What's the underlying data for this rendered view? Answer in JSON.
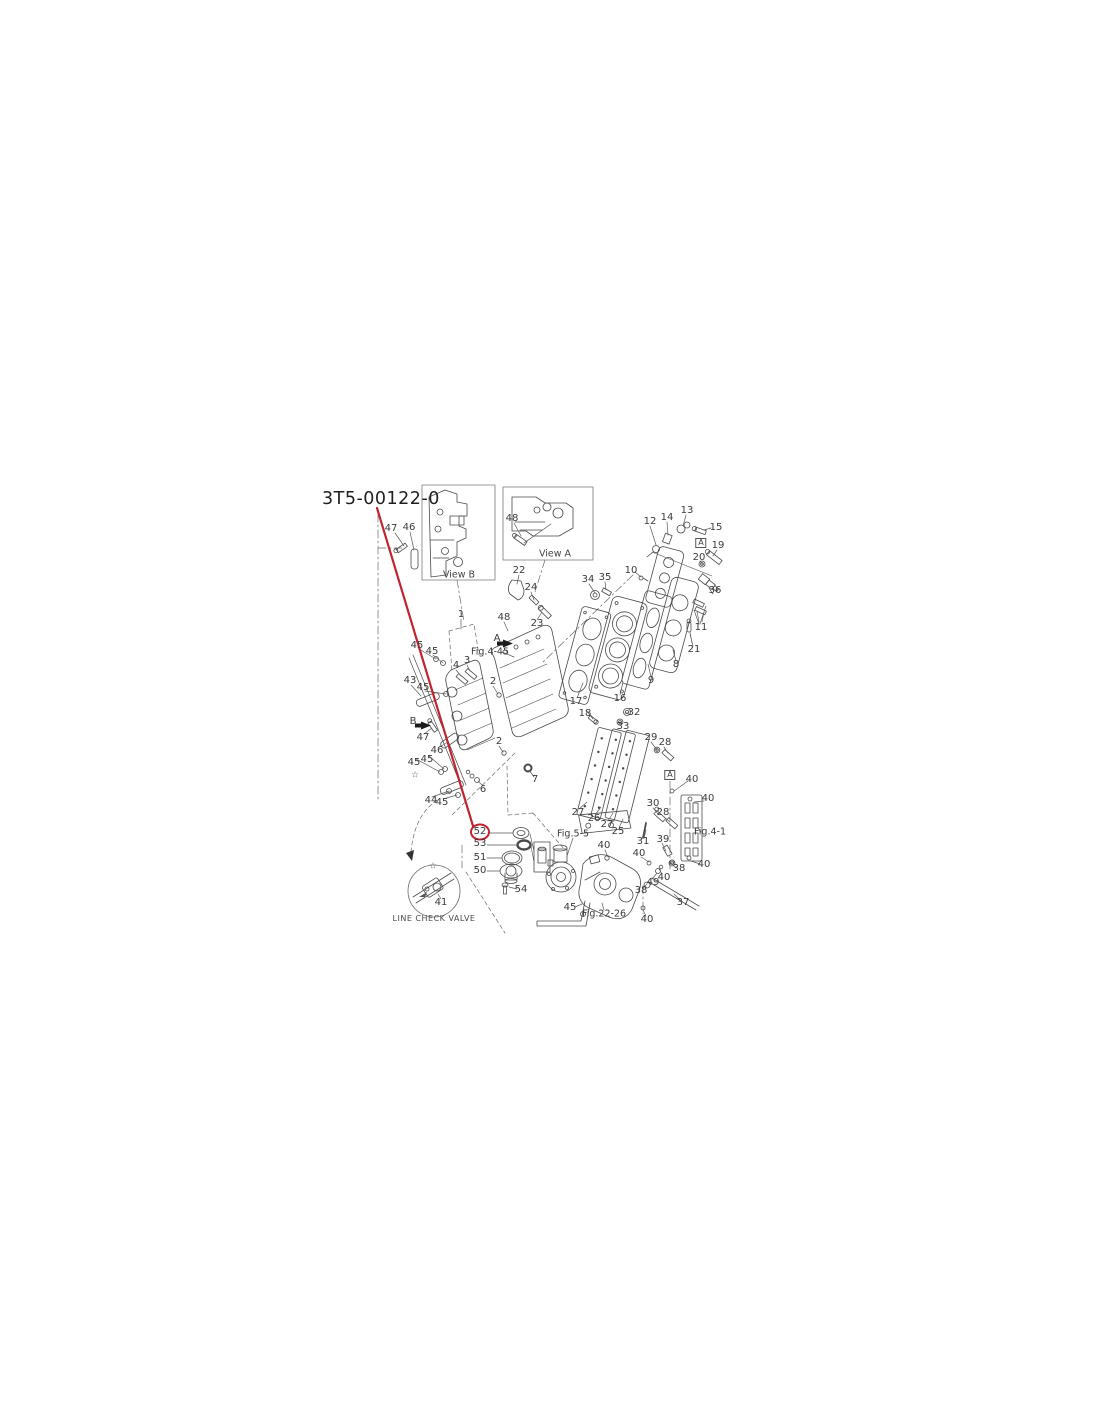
{
  "title": {
    "text": "3T5-00122-0"
  },
  "highlight": {
    "part": "52",
    "color": "#bf2430"
  },
  "diagram": {
    "stroke_color": "#4a4a4a",
    "labels": [
      {
        "t": "47",
        "x": 391,
        "y": 529
      },
      {
        "t": "46",
        "x": 409,
        "y": 528
      },
      {
        "t": "48",
        "x": 512,
        "y": 519
      },
      {
        "t": "22",
        "x": 519,
        "y": 571
      },
      {
        "t": "24",
        "x": 531,
        "y": 588
      },
      {
        "t": "23",
        "x": 537,
        "y": 624
      },
      {
        "t": "34",
        "x": 588,
        "y": 580
      },
      {
        "t": "35",
        "x": 605,
        "y": 578
      },
      {
        "t": "12",
        "x": 650,
        "y": 522
      },
      {
        "t": "14",
        "x": 667,
        "y": 518
      },
      {
        "t": "13",
        "x": 687,
        "y": 511
      },
      {
        "t": "15",
        "x": 716,
        "y": 528
      },
      {
        "t": "A",
        "x": 701,
        "y": 543,
        "s": "b",
        "n": "boxed-a-top"
      },
      {
        "t": "19",
        "x": 718,
        "y": 546
      },
      {
        "t": "20",
        "x": 699,
        "y": 558
      },
      {
        "t": "10",
        "x": 631,
        "y": 571
      },
      {
        "t": "36",
        "x": 715,
        "y": 591
      },
      {
        "t": "11",
        "x": 701,
        "y": 628
      },
      {
        "t": "21",
        "x": 694,
        "y": 650
      },
      {
        "t": "8",
        "x": 676,
        "y": 665
      },
      {
        "t": "9",
        "x": 651,
        "y": 681
      },
      {
        "t": "16",
        "x": 620,
        "y": 699
      },
      {
        "t": "17",
        "x": 576,
        "y": 702
      },
      {
        "t": "18",
        "x": 585,
        "y": 714
      },
      {
        "t": "32",
        "x": 634,
        "y": 713
      },
      {
        "t": "33",
        "x": 623,
        "y": 727
      },
      {
        "t": "29",
        "x": 651,
        "y": 738
      },
      {
        "t": "28",
        "x": 665,
        "y": 743
      },
      {
        "t": "1",
        "x": 461,
        "y": 615
      },
      {
        "t": "48",
        "x": 504,
        "y": 618
      },
      {
        "t": "A",
        "x": 497,
        "y": 639,
        "s": "L",
        "n": "arrow-label-a"
      },
      {
        "t": "Fig.4-45",
        "x": 490,
        "y": 652,
        "s": "f",
        "n": "fig-ref-4-45"
      },
      {
        "t": "3",
        "x": 467,
        "y": 661
      },
      {
        "t": "4",
        "x": 456,
        "y": 666
      },
      {
        "t": "2",
        "x": 493,
        "y": 682
      },
      {
        "t": "2",
        "x": 499,
        "y": 742
      },
      {
        "t": "45",
        "x": 417,
        "y": 646
      },
      {
        "t": "45",
        "x": 432,
        "y": 652
      },
      {
        "t": "43",
        "x": 410,
        "y": 681
      },
      {
        "t": "45",
        "x": 423,
        "y": 688
      },
      {
        "t": "B",
        "x": 413,
        "y": 722,
        "s": "L",
        "n": "arrow-label-b"
      },
      {
        "t": "47",
        "x": 423,
        "y": 738
      },
      {
        "t": "46",
        "x": 437,
        "y": 751
      },
      {
        "t": "45",
        "x": 414,
        "y": 763
      },
      {
        "t": "45",
        "x": 427,
        "y": 760
      },
      {
        "t": "44",
        "x": 431,
        "y": 801
      },
      {
        "t": "45",
        "x": 442,
        "y": 803
      },
      {
        "t": "6",
        "x": 483,
        "y": 790
      },
      {
        "t": "7",
        "x": 535,
        "y": 780
      },
      {
        "t": "52",
        "x": 480,
        "y": 832,
        "n": "part-label-52-highlighted"
      },
      {
        "t": "53",
        "x": 480,
        "y": 844
      },
      {
        "t": "51",
        "x": 480,
        "y": 858
      },
      {
        "t": "50",
        "x": 480,
        "y": 871
      },
      {
        "t": "54",
        "x": 521,
        "y": 890
      },
      {
        "t": "41",
        "x": 441,
        "y": 903
      },
      {
        "t": "LINE CHECK VALVE",
        "x": 434,
        "y": 919,
        "s": "c",
        "n": "line-check-valve-caption"
      },
      {
        "t": "27",
        "x": 578,
        "y": 813
      },
      {
        "t": "26",
        "x": 594,
        "y": 819
      },
      {
        "t": "27",
        "x": 607,
        "y": 825
      },
      {
        "t": "25",
        "x": 618,
        "y": 832
      },
      {
        "t": "30",
        "x": 653,
        "y": 804
      },
      {
        "t": "28",
        "x": 663,
        "y": 813
      },
      {
        "t": "31",
        "x": 643,
        "y": 842
      },
      {
        "t": "A",
        "x": 670,
        "y": 775,
        "s": "b",
        "n": "boxed-a-bottom"
      },
      {
        "t": "40",
        "x": 692,
        "y": 780
      },
      {
        "t": "40",
        "x": 708,
        "y": 799
      },
      {
        "t": "Fig.4-1",
        "x": 710,
        "y": 832,
        "s": "f",
        "n": "fig-ref-4-1"
      },
      {
        "t": "Fig.5-5",
        "x": 573,
        "y": 834,
        "s": "f",
        "n": "fig-ref-5-5"
      },
      {
        "t": "40",
        "x": 604,
        "y": 846
      },
      {
        "t": "39",
        "x": 663,
        "y": 840
      },
      {
        "t": "40",
        "x": 639,
        "y": 854
      },
      {
        "t": "38",
        "x": 679,
        "y": 869
      },
      {
        "t": "40",
        "x": 664,
        "y": 878
      },
      {
        "t": "49",
        "x": 653,
        "y": 883
      },
      {
        "t": "38",
        "x": 641,
        "y": 891
      },
      {
        "t": "37",
        "x": 683,
        "y": 903
      },
      {
        "t": "40",
        "x": 704,
        "y": 865
      },
      {
        "t": "45",
        "x": 570,
        "y": 908
      },
      {
        "t": "Fig.22-26",
        "x": 604,
        "y": 914,
        "s": "f",
        "n": "fig-ref-22-26"
      },
      {
        "t": "40",
        "x": 647,
        "y": 920
      },
      {
        "t": "View B",
        "x": 459,
        "y": 575,
        "s": "v",
        "n": "view-b-caption"
      },
      {
        "t": "View A",
        "x": 555,
        "y": 554,
        "s": "v",
        "n": "view-a-caption"
      },
      {
        "t": "☆",
        "x": 433,
        "y": 867,
        "s": "s",
        "n": "star-mark"
      },
      {
        "t": "☆",
        "x": 415,
        "y": 776,
        "s": "s",
        "n": "star-mark"
      }
    ]
  }
}
